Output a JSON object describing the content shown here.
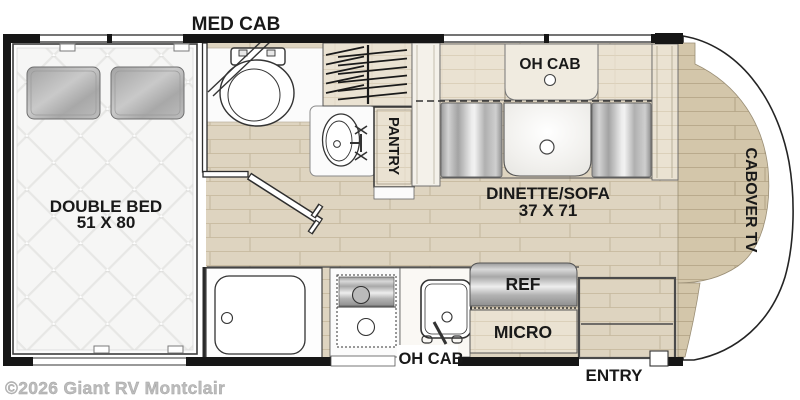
{
  "floorplan": {
    "bathroom": {
      "med_cab_label": "MED CAB"
    },
    "bedroom": {
      "line1": "DOUBLE BED",
      "line2": "51 X 80"
    },
    "closet": {
      "pantry_label": "PANTRY"
    },
    "dinette": {
      "oh_cab_label": "OH CAB",
      "line1": "DINETTE/SOFA",
      "line2": "37 X 71"
    },
    "kitchen": {
      "ref_label": "REF",
      "micro_label": "MICRO",
      "oh_cab_label": "OH CAB"
    },
    "cab": {
      "tv_label": "CABOVER TV"
    },
    "entry_label": "ENTRY"
  },
  "watermark": {
    "text": "©2026 Giant RV Montclair"
  },
  "colors": {
    "wall": "#161616",
    "floor": "#ded4c0",
    "floor_lines": "#cabda3",
    "cab_floor": "#d3c6aa",
    "cabinet_wood": "#eae2d2",
    "metal_dark": "#9a9a9a",
    "metal_light": "#ececec",
    "label_text": "#191919",
    "watermark_gray": "#bcbcbc"
  }
}
